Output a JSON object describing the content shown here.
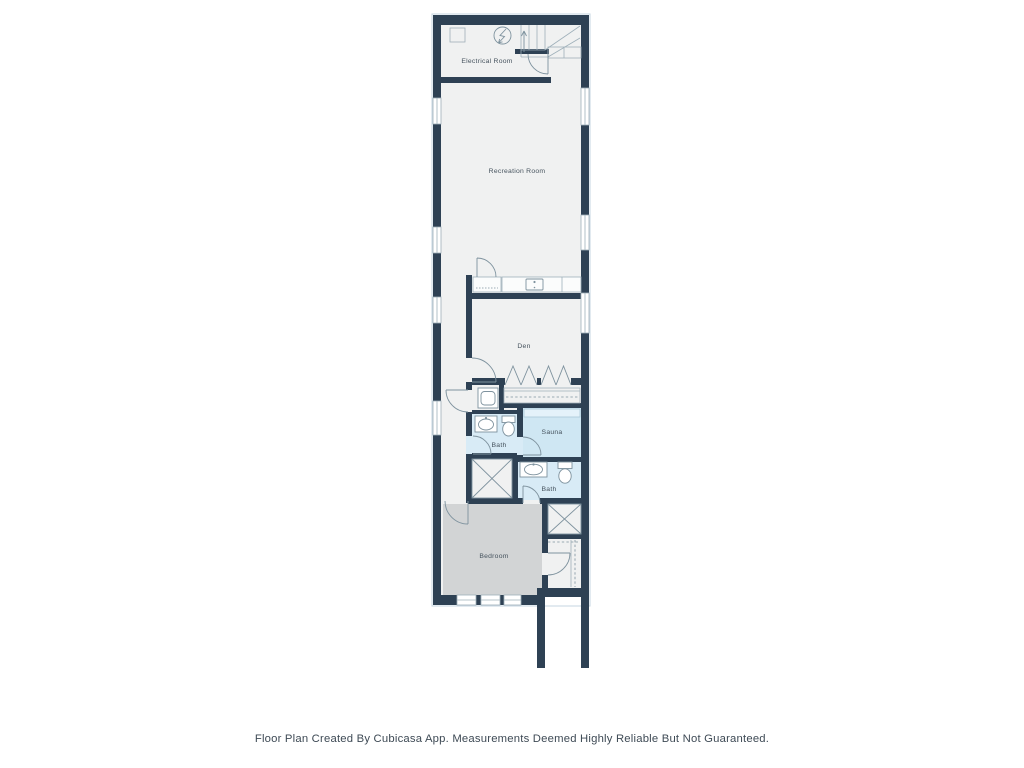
{
  "colors": {
    "wall": "#2e4154",
    "halo": "#c5d5e0",
    "floor": "#f0f1f1",
    "bedroom_floor": "#d2d4d5",
    "bath_floor": "#d8ebf6",
    "sauna_floor": "#cfe7f3",
    "line": "#7e929e",
    "line_light": "#9fb0ba",
    "label": "#46535e",
    "footer_color": "#3e4a55"
  },
  "rooms": {
    "electrical_room": {
      "label": "Electrical Room"
    },
    "recreation_room": {
      "label": "Recreation Room"
    },
    "den": {
      "label": "Den"
    },
    "bath_upper": {
      "label": "Bath"
    },
    "sauna": {
      "label": "Sauna"
    },
    "bath_lower": {
      "label": "Bath"
    },
    "bedroom": {
      "label": "Bedroom"
    }
  },
  "footer": {
    "text": "Floor Plan Created By Cubicasa App. Measurements Deemed Highly Reliable But Not Guaranteed."
  }
}
